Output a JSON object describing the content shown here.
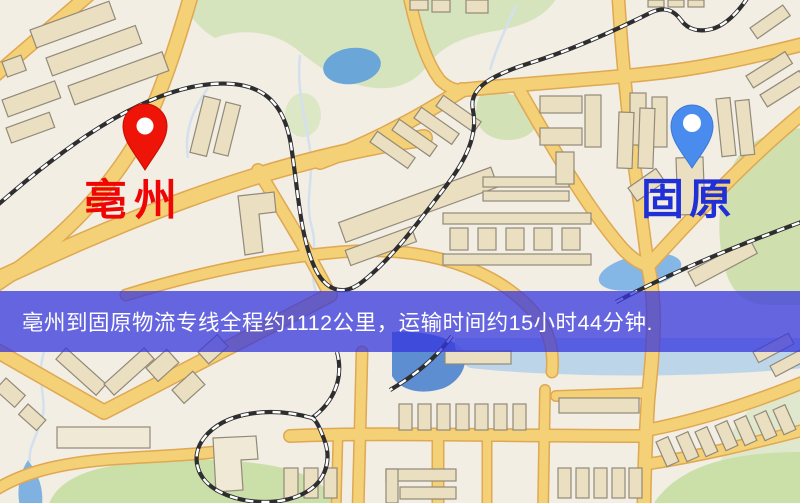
{
  "page": {
    "width": 800,
    "height": 503
  },
  "map": {
    "type": "route-overview-map",
    "markers": [
      {
        "id": "origin",
        "label": "亳州",
        "pin_color": "#ee1408",
        "label_color": "#ef0505"
      },
      {
        "id": "destination",
        "label": "固原",
        "pin_color": "#4a8cee",
        "label_color": "#2130d6"
      }
    ],
    "banner": {
      "text": "亳州到固原物流专线全程约1112公里，运输时间约15小时44分钟.",
      "distance_text": "约1112公里",
      "duration_text": "约15小时44分钟",
      "background": "#3434de",
      "text_color": "#ffffff"
    },
    "legend_colors": {
      "road": "#f4d077",
      "road_casing": "#dfa852",
      "building": "#eae0c1",
      "green_area": "#cfe0ae",
      "water": "#6aa6d8",
      "railway": "#2e2e30",
      "background": "#f2eee3"
    }
  }
}
